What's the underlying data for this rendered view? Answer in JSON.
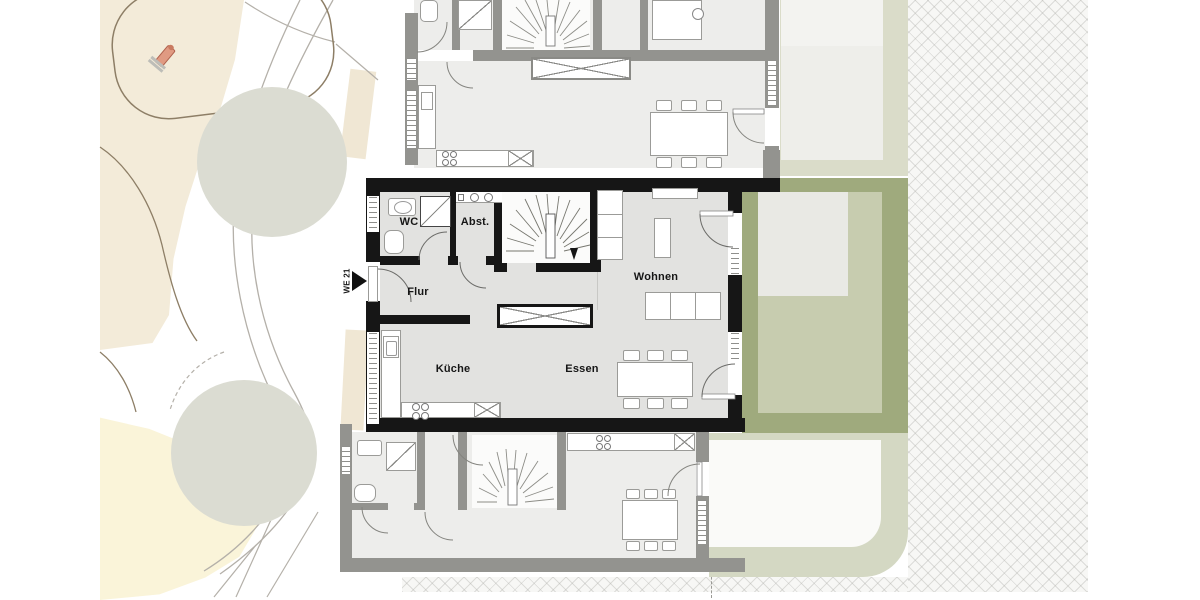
{
  "plan": {
    "unit_tag": "WE 21",
    "rooms": {
      "wc": "WC",
      "abst": "Abst.",
      "flur": "Flur",
      "kueche": "Küche",
      "essen": "Essen",
      "wohnen": "Wohnen"
    },
    "palette": {
      "highlight_wall": "#161616",
      "neighbor_wall": "#93938f",
      "room_floor": "#e2e2e0",
      "neighbor_floor": "#ededeb",
      "stair_floor": "#fbfbfa",
      "garden_hedge": "#9faa7d",
      "garden_lawn": "#c7ccaf",
      "garden_neighbor_upper": "#dadcc9",
      "garden_neighbor_lower": "#d4d8c3",
      "terrace_gray": "#e9e9e4",
      "terrace_white": "#fafaf8",
      "playground_beige": "#f3ebd9",
      "sand_yellow": "#faf4d9",
      "tree_canopy": "#dbdcd2",
      "path_line": "#b4b0a9",
      "terrain_line": "#8d7e66",
      "hatch_line": "#c9c9c4",
      "toy_red": "#dd9077"
    }
  }
}
